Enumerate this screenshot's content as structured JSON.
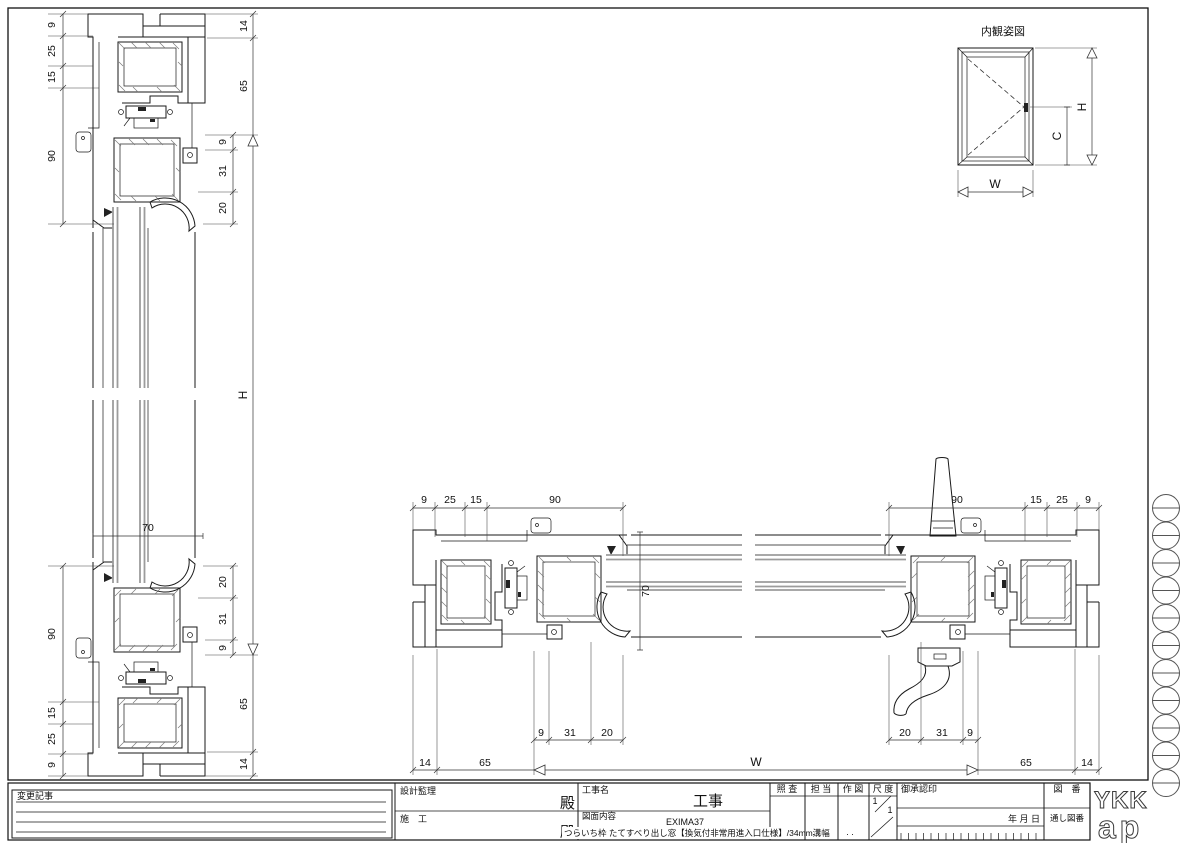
{
  "elevation": {
    "title": "内観姿図",
    "width_label": "W",
    "height_label": "H",
    "handle_height_label": "C"
  },
  "vertical_section": {
    "glass_thickness": "70",
    "height_label": "H",
    "head_outer_dims": [
      "9",
      "25",
      "15",
      "90"
    ],
    "sill_outer_dims": [
      "90",
      "15",
      "25",
      "9"
    ],
    "head_side_dims": [
      "14",
      "65"
    ],
    "sill_side_dims": [
      "65",
      "14"
    ],
    "head_inner_dims": [
      "9",
      "31",
      "20"
    ],
    "sill_inner_dims": [
      "20",
      "31",
      "9"
    ]
  },
  "horizontal_section": {
    "glass_thickness": "70",
    "width_label": "W",
    "left_outer_dims": [
      "9",
      "25",
      "15",
      "90"
    ],
    "right_outer_dims": [
      "90",
      "15",
      "25",
      "9"
    ],
    "left_inner_dims": [
      "9",
      "31",
      "20"
    ],
    "right_inner_dims": [
      "20",
      "31",
      "9"
    ],
    "left_edge_dims": [
      "14",
      "65"
    ],
    "right_edge_dims": [
      "65",
      "14"
    ]
  },
  "title_block": {
    "change_notes_label": "変更記事",
    "design_supervision_label": "設計監理",
    "construction_label": "施　工",
    "dono_top": "殿",
    "dono_bottom": "殿",
    "project_name_label": "工事名",
    "project_suffix": "工事",
    "drawing_content_label": "図面内容",
    "product_series": "EXIMA37",
    "drawing_title": "つらいち枠 たてすべり出し窓【換気付非常用進入口仕様】/34mm溝幅",
    "check_label": "照 査",
    "in_charge_label": "担 当",
    "drafting_label": "作 図",
    "scale_label": "尺 度",
    "scale_numerator": "1",
    "scale_denominator": "1",
    "approval_label": "御承認印",
    "date_label": "年 月 日",
    "drawing_no_label": "図　番",
    "serial_no_label": "通し図番",
    "dots_in_charge": ". .",
    "dots_drafting": ". .",
    "logo_line1": "YKK",
    "logo_line2": "ap"
  }
}
